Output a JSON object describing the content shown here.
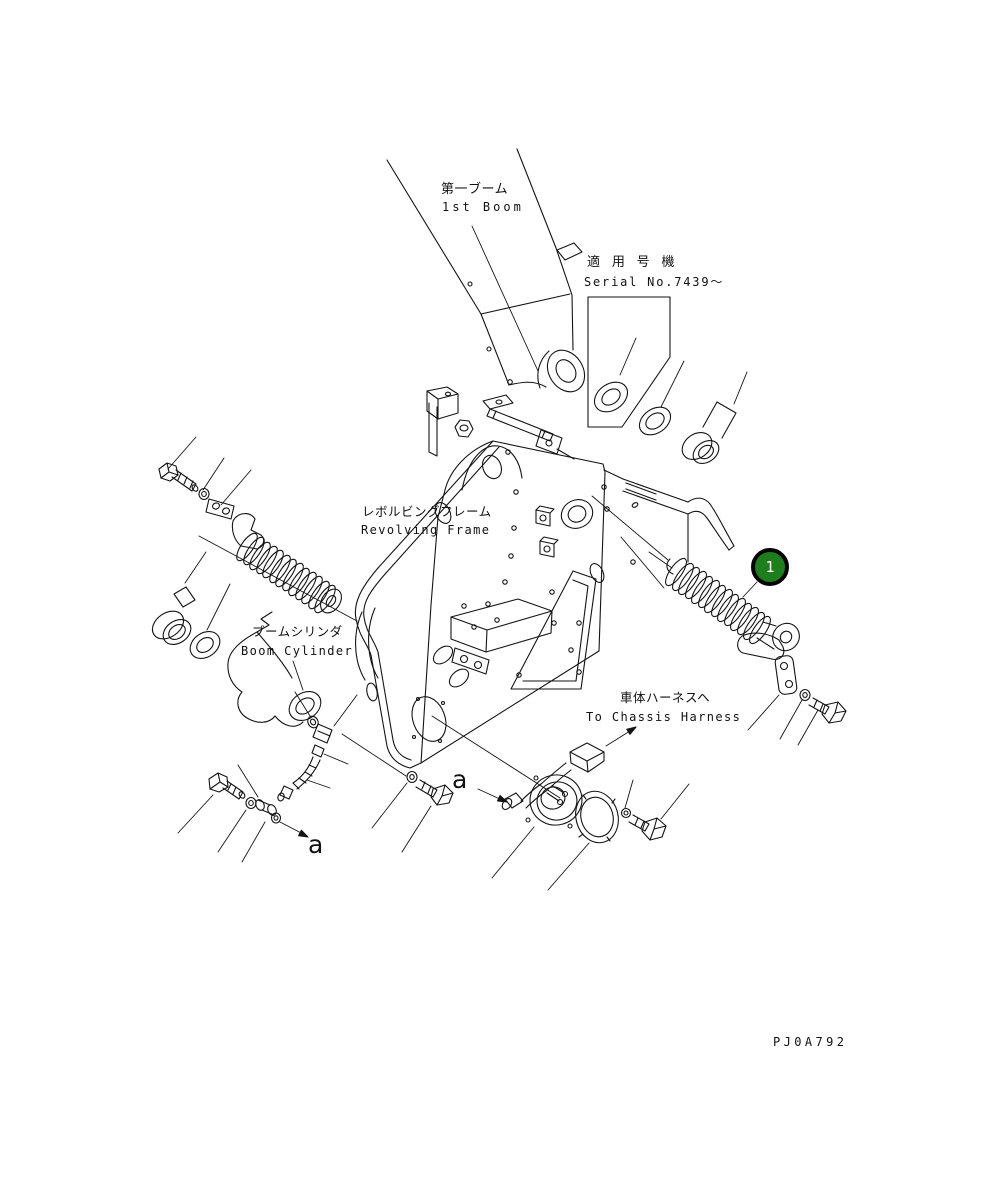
{
  "drawing": {
    "code": "PJ0A792",
    "callout_1": "1",
    "colors": {
      "callout_green": "#1e7e1e",
      "line": "#141414"
    },
    "labels": {
      "boom_jp": "第一ブーム",
      "boom_en": "1st Boom",
      "serial_jp": "適 用 号 機",
      "serial_en": "Serial No.7439〜",
      "revolving_frame_jp": "レボルビングフレーム",
      "revolving_frame_en": "Revolving Frame",
      "boom_cylinder_jp": "ブームシリンダ",
      "boom_cylinder_en": "Boom Cylinder",
      "chassis_harness_jp": "車体ハーネスヘ",
      "chassis_harness_en": "To Chassis Harness",
      "view_arrow_left": "a",
      "view_arrow_center": "a"
    }
  }
}
